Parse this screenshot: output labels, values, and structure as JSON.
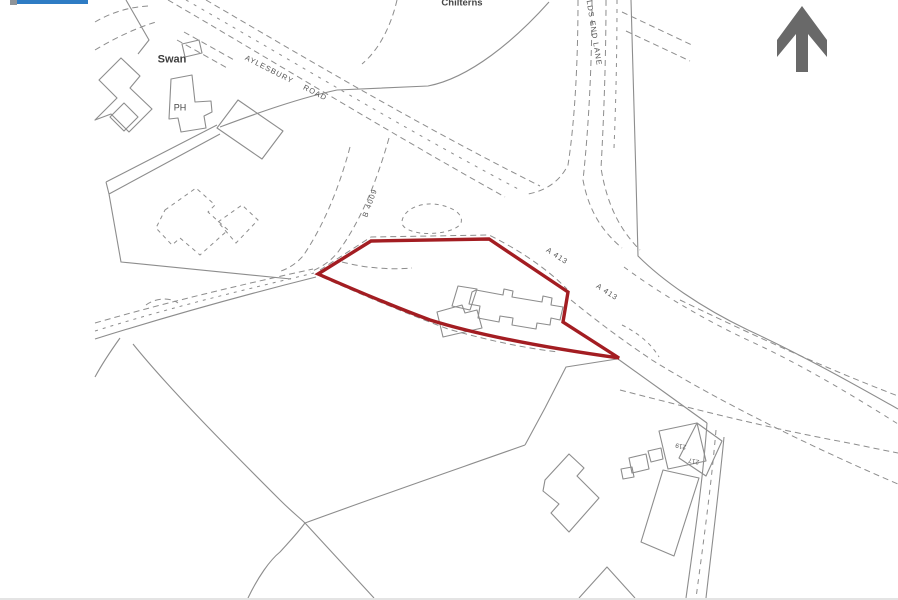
{
  "window": {
    "width": 898,
    "height": 598,
    "background": "#ffffff",
    "top_bar_color": "#2e7cc4",
    "top_tab_color": "#8f9499"
  },
  "map": {
    "kind": "site-location-plan",
    "boundary_color": "#a31d22",
    "line_color": "#8d8d8d",
    "north_arrow_color": "#696969",
    "labels": {
      "swan": "Swan",
      "ph": "PH",
      "chilterns": "Chilterns",
      "aylesbury_road": "AYLESBURY ROAD",
      "b4009": "B 4009",
      "worlds_end_lane": "LDS END LANE",
      "a413_upper": "A 413",
      "a413_lower": "A 413",
      "house_left": "219",
      "house_right": "217"
    }
  }
}
